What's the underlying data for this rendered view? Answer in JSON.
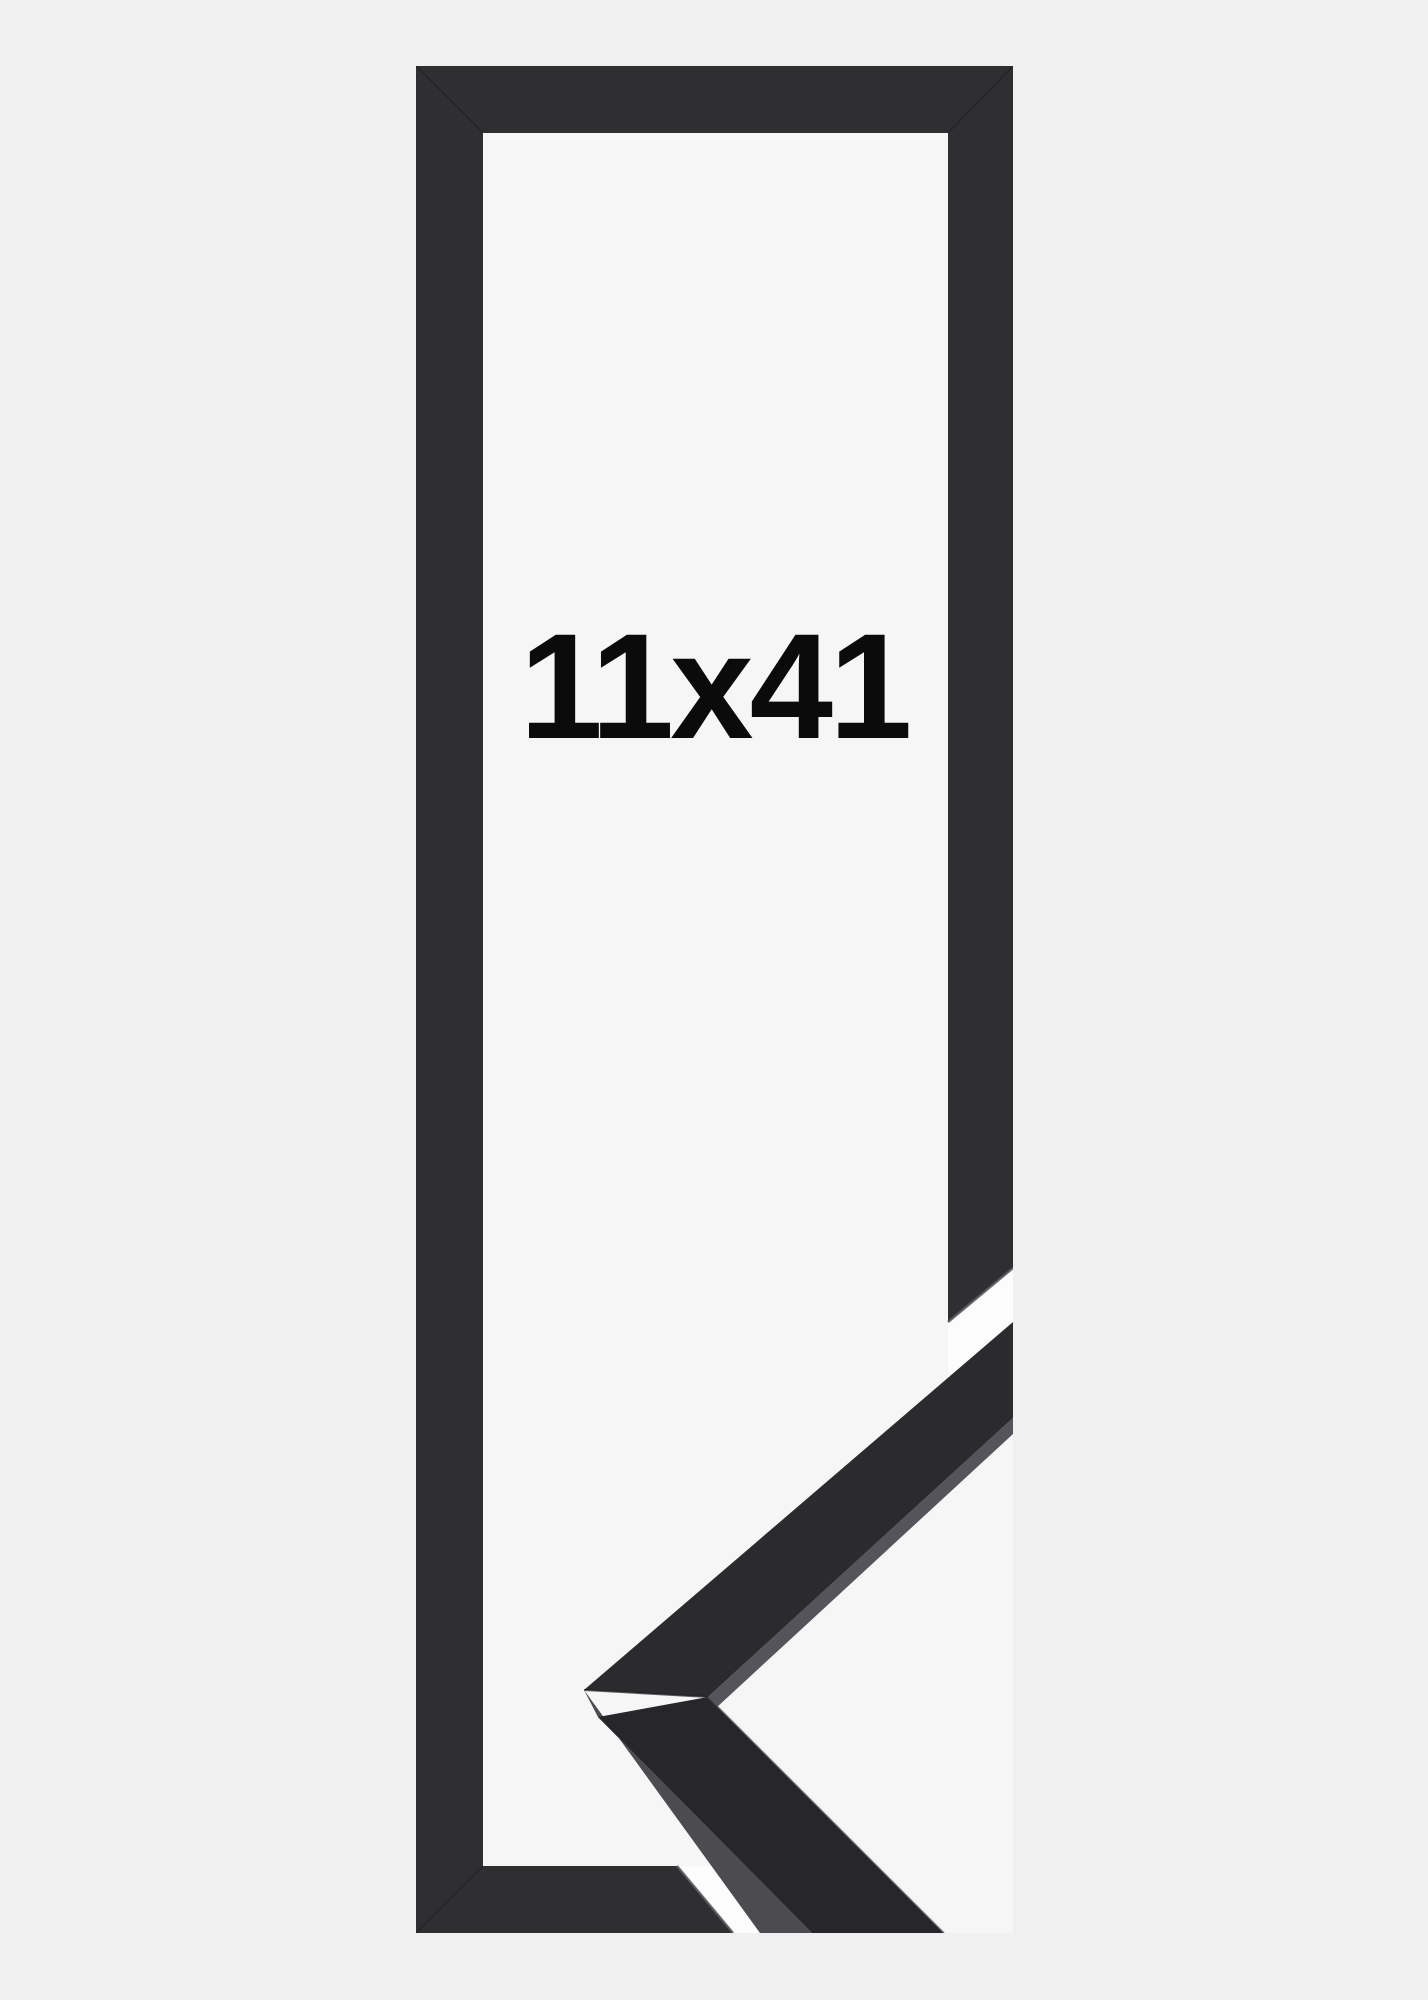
{
  "product": {
    "size_label": "11x41",
    "frame_color_name": "black",
    "colors": {
      "page_background": "#f0f0f1",
      "photo_background": "#f6f6f7",
      "frame_face": "#2f2f32",
      "chevron_upper_face": "#2b2b2e",
      "chevron_lower_face": "#27272b",
      "moulding_side": "#4b4b50",
      "edge_highlight": "#55555a",
      "sliver_highlight": "#54545a",
      "gap_white": "#fcfcfd",
      "seam": "#1f1f22",
      "text": "#0b0b0b"
    }
  }
}
